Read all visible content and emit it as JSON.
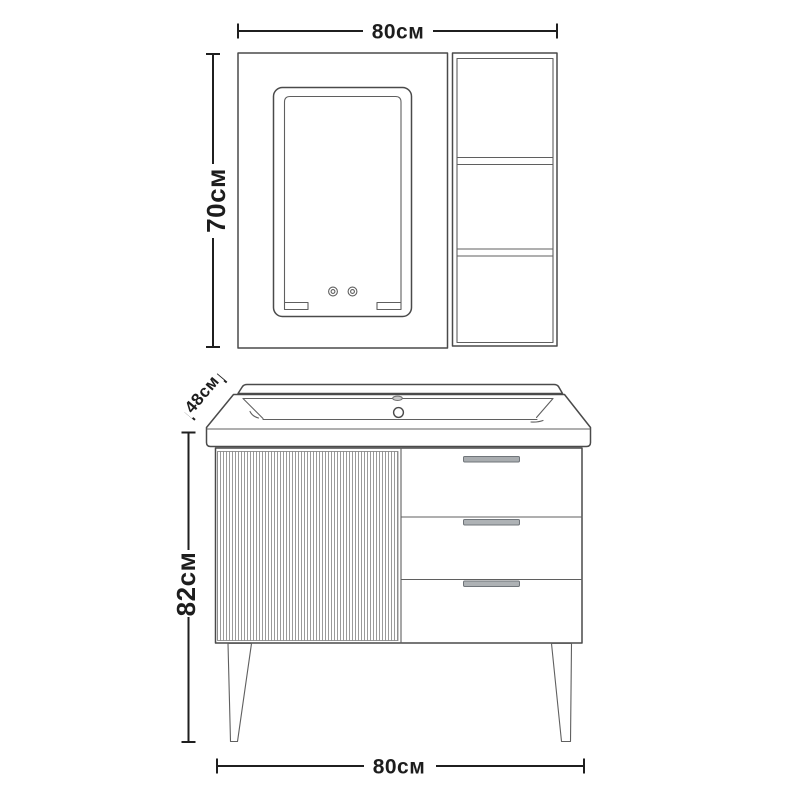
{
  "figure": {
    "type": "technical-line-drawing",
    "subject": "bathroom vanity set with mirror cabinet, side shelf unit, ceramic basin, fluted door, three drawers and tapered legs (front view)"
  },
  "colors": {
    "background": "#ffffff",
    "outline": "#4a4a4a",
    "dimension_line": "#1f1f1f",
    "flute_line": "#8f8f8f",
    "handle_fill": "#a9adb0",
    "handle_border": "#70757a"
  },
  "dimensions": {
    "mirror_width": {
      "label": "80см",
      "orientation": "horizontal-top"
    },
    "mirror_height": {
      "label": "70см",
      "orientation": "vertical-left"
    },
    "basin_depth": {
      "label": "48см",
      "orientation": "diagonal"
    },
    "cabinet_height": {
      "label": "82см",
      "orientation": "vertical-left"
    },
    "cabinet_width": {
      "label": "80см",
      "orientation": "horizontal-bottom"
    }
  }
}
